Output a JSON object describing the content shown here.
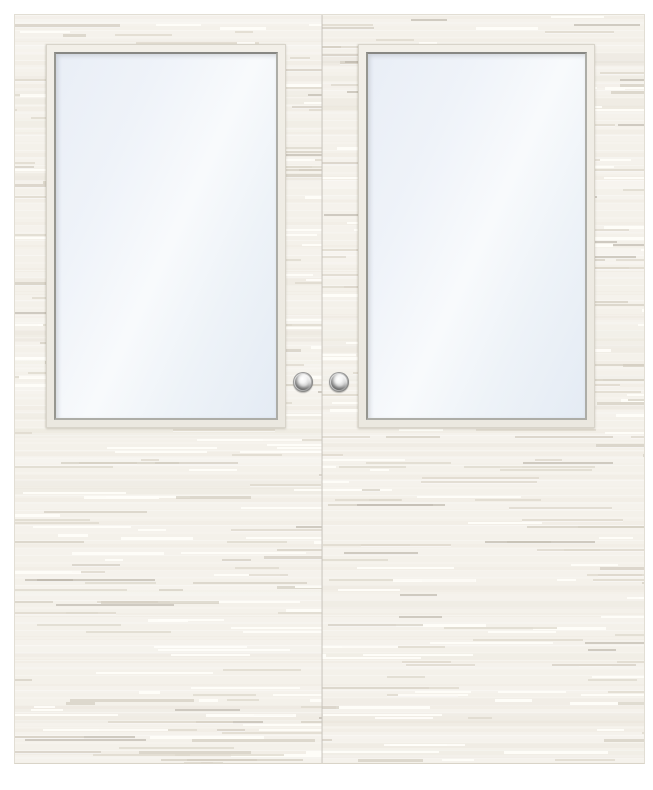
{
  "scene": {
    "name": "closed white double door with half-glass panels",
    "door_count": 2,
    "doors": [
      {
        "id": "left",
        "panel": "white painted leaf with horizontal plank texture",
        "window": "half glass panel",
        "knob": "round metal knob"
      },
      {
        "id": "right",
        "panel": "white painted leaf with horizontal plank texture",
        "window": "half glass panel",
        "knob": "round metal knob"
      }
    ]
  },
  "theme": {
    "page_bg": "#ffffff",
    "door_surface": "#f4f1ea",
    "door_edge": "#e2ded4",
    "frame_face": "#f2efe8",
    "frame_edge": "#d8d4ca",
    "bevel_dark": "#878783",
    "glass_top": "#e9eef6",
    "glass_mid": "#f8fafc",
    "glass_bottom": "#e4ebf4",
    "streak_light": "#fffefa",
    "streak_dark": "#ded8cc",
    "streak_mid": "#d3cdc1",
    "streak_strong": "#bcb6aa",
    "knob_highlight": "#ffffff",
    "knob_shadow": "#606060",
    "seam": "#a89f90"
  }
}
